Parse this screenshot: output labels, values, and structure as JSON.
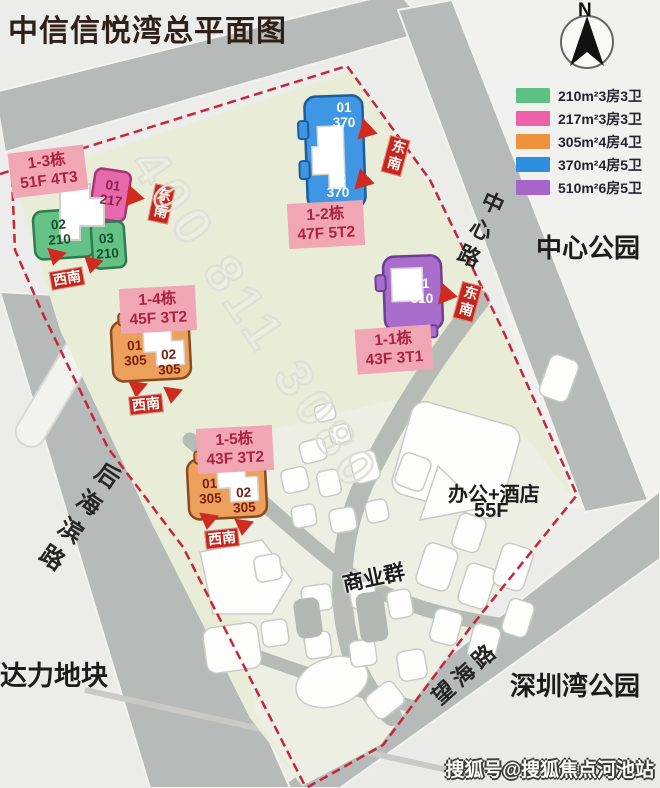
{
  "title": "中信信悦湾总平面图",
  "compass": {
    "n": "N"
  },
  "legend": {
    "items": [
      {
        "color": "#5ec184",
        "label": "210m²3房3卫"
      },
      {
        "color": "#ee61a9",
        "label": "217m²3房3卫"
      },
      {
        "color": "#ef923d",
        "label": "305m²4房4卫"
      },
      {
        "color": "#2f8fdf",
        "label": "370m²4房5卫"
      },
      {
        "color": "#a865c9",
        "label": "510m²6房5卫"
      }
    ]
  },
  "places": {
    "center_park": "中心公园",
    "shenzhen_bay_park": "深圳湾公园",
    "dali_plot": "达力地块",
    "commercial_group": "商业群",
    "office_hotel_line1": "办公+酒店",
    "office_hotel_line2": "55F"
  },
  "roads": {
    "zhongxin": "中心路",
    "houhaibin": "后海滨路",
    "wanghai": "望海路"
  },
  "directions": {
    "dongnan": "东南",
    "xinan": "西南"
  },
  "buildings": [
    {
      "id": "1-3",
      "name_line1": "1-3栋",
      "name_line2": "51F 4T3",
      "units": [
        {
          "num": "01",
          "size": "217"
        },
        {
          "num": "02",
          "size": "210"
        },
        {
          "num": "03",
          "size": "210"
        }
      ]
    },
    {
      "id": "1-2",
      "name_line1": "1-2栋",
      "name_line2": "47F  5T2",
      "units": [
        {
          "num": "01",
          "size": "370"
        },
        {
          "num": "02",
          "size": "370"
        }
      ]
    },
    {
      "id": "1-1",
      "name_line1": "1-1栋",
      "name_line2": "43F  3T1",
      "units": [
        {
          "num": "01",
          "size": "510"
        }
      ]
    },
    {
      "id": "1-4",
      "name_line1": "1-4栋",
      "name_line2": "45F  3T2",
      "units": [
        {
          "num": "01",
          "size": "305"
        },
        {
          "num": "02",
          "size": "305"
        }
      ]
    },
    {
      "id": "1-5",
      "name_line1": "1-5栋",
      "name_line2": "43F  3T2",
      "units": [
        {
          "num": "01",
          "size": "305"
        },
        {
          "num": "02",
          "size": "305"
        }
      ]
    }
  ],
  "watermarks": {
    "phone": "400 811 3080",
    "social": "搜狐号@搜狐焦点河池站"
  },
  "colors": {
    "boundary_dashed": "#c4273b",
    "road": "#b6bab8",
    "site_fill": "#e9edd8",
    "label_pink_bg": "#f1a6b4",
    "label_pink_text": "#a92440",
    "direction_tag": "#c5271d"
  }
}
